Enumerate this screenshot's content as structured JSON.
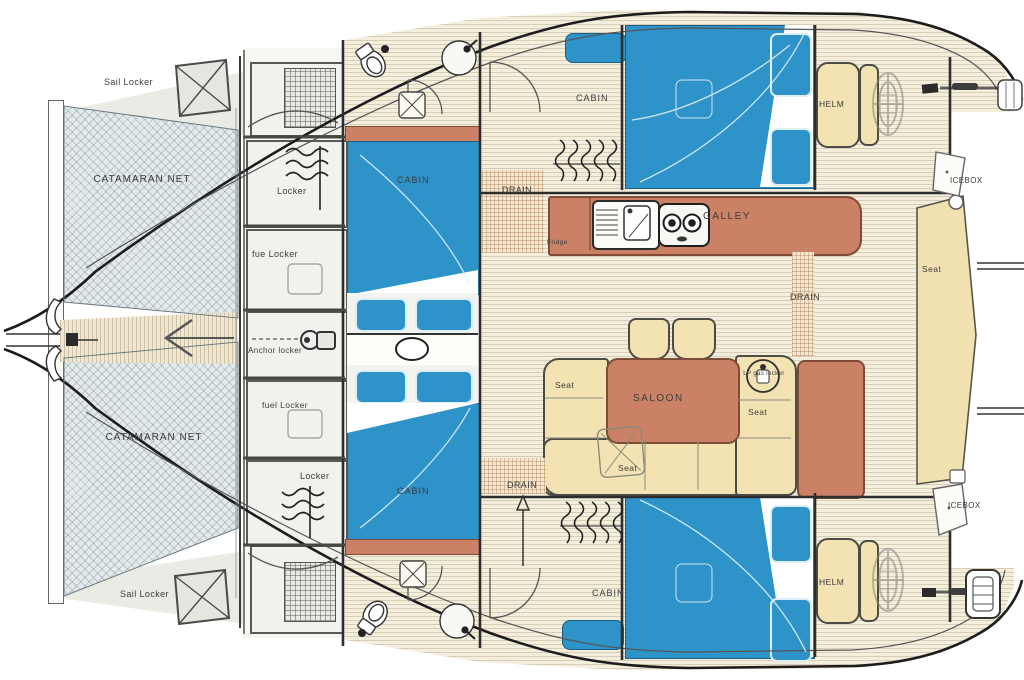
{
  "diagram": {
    "title": "Catamaran layout floor plan",
    "type": "floor-plan",
    "colors": {
      "bed_blue": "#2e93c8",
      "furniture_terracotta": "#cb8166",
      "seat_cream": "#f3e3b3",
      "net_gray": "#e4eaeb",
      "floor_cream": "#f4eedd",
      "line_dark": "#2b2b2b"
    },
    "labels": {
      "sail_locker_top": "Sail Locker",
      "catamaran_net_top": "CATAMARAN NET",
      "locker_fwd": "Locker",
      "fue_locker": "fue  Locker",
      "anchor_locker": "Anchor locker",
      "fuel_locker": "fuel  Locker",
      "locker_aft": "Locker",
      "catamaran_net_bottom": "CATAMARAN NET",
      "sail_locker_bottom": "Sail Locker",
      "cabin_mid_fwd": "CABIN",
      "cabin_mid_aft": "CABIN",
      "cabin_hull_top": "CABIN",
      "cabin_hull_bottom": "CABIN",
      "drain_top": "DRAIN",
      "drain_mid": "DRAIN",
      "drain_bottom": "DRAIN",
      "galley": "GALLEY",
      "fridge": "Fridge",
      "saloon": "SALOON",
      "seat_left": "Seat",
      "seat_right": "Seat",
      "seat_front": "Seat",
      "seat_aft_deck": "Seat",
      "lp_gas_locker": "LP gas locker",
      "helm_top": "HELM",
      "helm_bottom": "HELM",
      "icebox_top": "ICEBOX",
      "icebox_bottom": "ICEBOX"
    }
  }
}
